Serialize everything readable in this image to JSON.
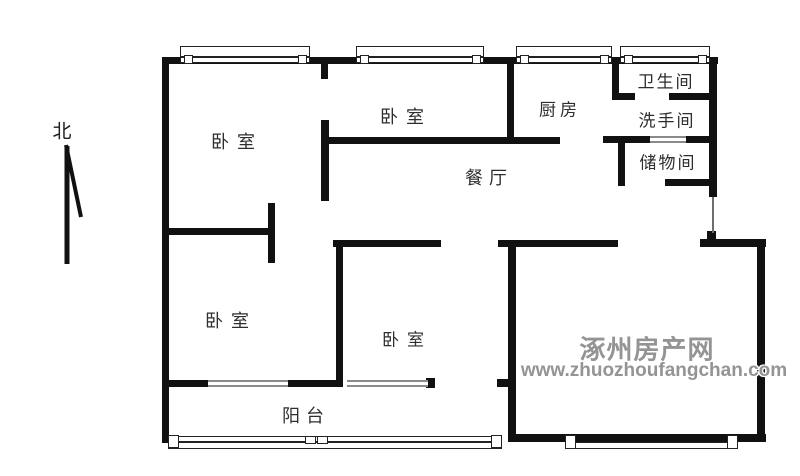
{
  "canvas": {
    "width": 800,
    "height": 476,
    "background": "#ffffff",
    "wall_color": "#111111"
  },
  "compass": {
    "label": "北"
  },
  "watermark": {
    "line1": "涿州房产网",
    "line2": "www.zhuozhoufangchan.com",
    "color": "#949494"
  },
  "floorplan": {
    "room_labels": [
      {
        "id": "bedroom-top-left",
        "label": "卧室",
        "x": 233,
        "y": 141,
        "fs": 18,
        "ls": 8
      },
      {
        "id": "bedroom-top-middle",
        "label": "卧室",
        "x": 402,
        "y": 116,
        "fs": 18,
        "ls": 8
      },
      {
        "id": "kitchen",
        "label": "厨房",
        "x": 558,
        "y": 108,
        "fs": 17,
        "ls": 4
      },
      {
        "id": "bathroom",
        "label": "卫生间",
        "x": 665,
        "y": 80,
        "fs": 17,
        "ls": 2
      },
      {
        "id": "washroom",
        "label": "洗手间",
        "x": 666,
        "y": 119,
        "fs": 17,
        "ls": 2
      },
      {
        "id": "storage-room",
        "label": "储物间",
        "x": 667,
        "y": 161,
        "fs": 17,
        "ls": 2
      },
      {
        "id": "dining-room",
        "label": "餐厅",
        "x": 486,
        "y": 177,
        "fs": 18,
        "ls": 6
      },
      {
        "id": "bedroom-bottom-left",
        "label": "卧室",
        "x": 227,
        "y": 320,
        "fs": 18,
        "ls": 8
      },
      {
        "id": "bedroom-bottom-middle",
        "label": "卧室",
        "x": 403,
        "y": 338,
        "fs": 17,
        "ls": 8
      },
      {
        "id": "balcony",
        "label": "阳台",
        "x": 303,
        "y": 415,
        "fs": 18,
        "ls": 6
      }
    ],
    "walls": [
      [
        162,
        57,
        556,
        7
      ],
      [
        162,
        57,
        7,
        386
      ],
      [
        709,
        57,
        8,
        140
      ],
      [
        707,
        231,
        9,
        10
      ],
      [
        700,
        239,
        66,
        8
      ],
      [
        757,
        239,
        8,
        203
      ],
      [
        508,
        434,
        258,
        8
      ],
      [
        321,
        57,
        7,
        22
      ],
      [
        321,
        120,
        8,
        81
      ],
      [
        322,
        137,
        238,
        7
      ],
      [
        507,
        57,
        7,
        87
      ],
      [
        612,
        57,
        7,
        43
      ],
      [
        612,
        93,
        23,
        7
      ],
      [
        669,
        93,
        43,
        7
      ],
      [
        603,
        136,
        47,
        7
      ],
      [
        685,
        136,
        27,
        7
      ],
      [
        618,
        136,
        7,
        50
      ],
      [
        665,
        179,
        47,
        7
      ],
      [
        162,
        228,
        110,
        7
      ],
      [
        268,
        203,
        7,
        60
      ],
      [
        333,
        240,
        108,
        7
      ],
      [
        498,
        240,
        120,
        7
      ],
      [
        508,
        240,
        8,
        202
      ],
      [
        336,
        243,
        7,
        144
      ],
      [
        162,
        380,
        46,
        7
      ],
      [
        287,
        380,
        51,
        7
      ],
      [
        426,
        378,
        9,
        10
      ],
      [
        497,
        379,
        11,
        8
      ]
    ],
    "thin_lines": [
      [
        712,
        197,
        2,
        36
      ]
    ],
    "windows": [
      {
        "name": "window-top-bedroom-left",
        "rect": [
          180,
          46,
          130,
          17
        ],
        "mid": [
          181,
          56,
          128,
          2
        ],
        "caps": [
          [
            184,
            55,
            9,
            9
          ],
          [
            298,
            55,
            9,
            9
          ]
        ]
      },
      {
        "name": "window-top-bedroom-middle",
        "rect": [
          356,
          46,
          128,
          17
        ],
        "mid": [
          357,
          56,
          126,
          2
        ],
        "caps": [
          [
            360,
            55,
            9,
            9
          ],
          [
            472,
            55,
            9,
            9
          ]
        ]
      },
      {
        "name": "window-top-kitchen",
        "rect": [
          516,
          46,
          96,
          17
        ],
        "mid": [
          517,
          56,
          94,
          2
        ],
        "caps": [
          [
            520,
            55,
            9,
            9
          ],
          [
            600,
            55,
            9,
            9
          ]
        ]
      },
      {
        "name": "window-top-bathroom",
        "rect": [
          620,
          46,
          90,
          17
        ],
        "mid": [
          621,
          56,
          88,
          2
        ],
        "caps": [
          [
            624,
            55,
            9,
            9
          ],
          [
            698,
            55,
            9,
            9
          ]
        ]
      },
      {
        "name": "window-bottom-living",
        "rect": [
          566,
          442,
          172,
          7
        ],
        "mid": null,
        "caps": [
          [
            565,
            435,
            11,
            14
          ],
          [
            727,
            435,
            11,
            14
          ]
        ]
      },
      {
        "name": "balcony-railing",
        "rect": [
          168,
          436,
          334,
          13
        ],
        "mid": [
          178,
          441,
          316,
          2
        ],
        "caps": [
          [
            168,
            435,
            11,
            13
          ],
          [
            491,
            435,
            11,
            13
          ],
          [
            305,
            436,
            11,
            8
          ],
          [
            317,
            436,
            11,
            8
          ]
        ]
      }
    ],
    "gray_windows": [
      [
        208,
        380,
        80,
        7
      ],
      [
        347,
        380,
        81,
        7
      ],
      [
        650,
        136,
        36,
        7
      ]
    ]
  }
}
